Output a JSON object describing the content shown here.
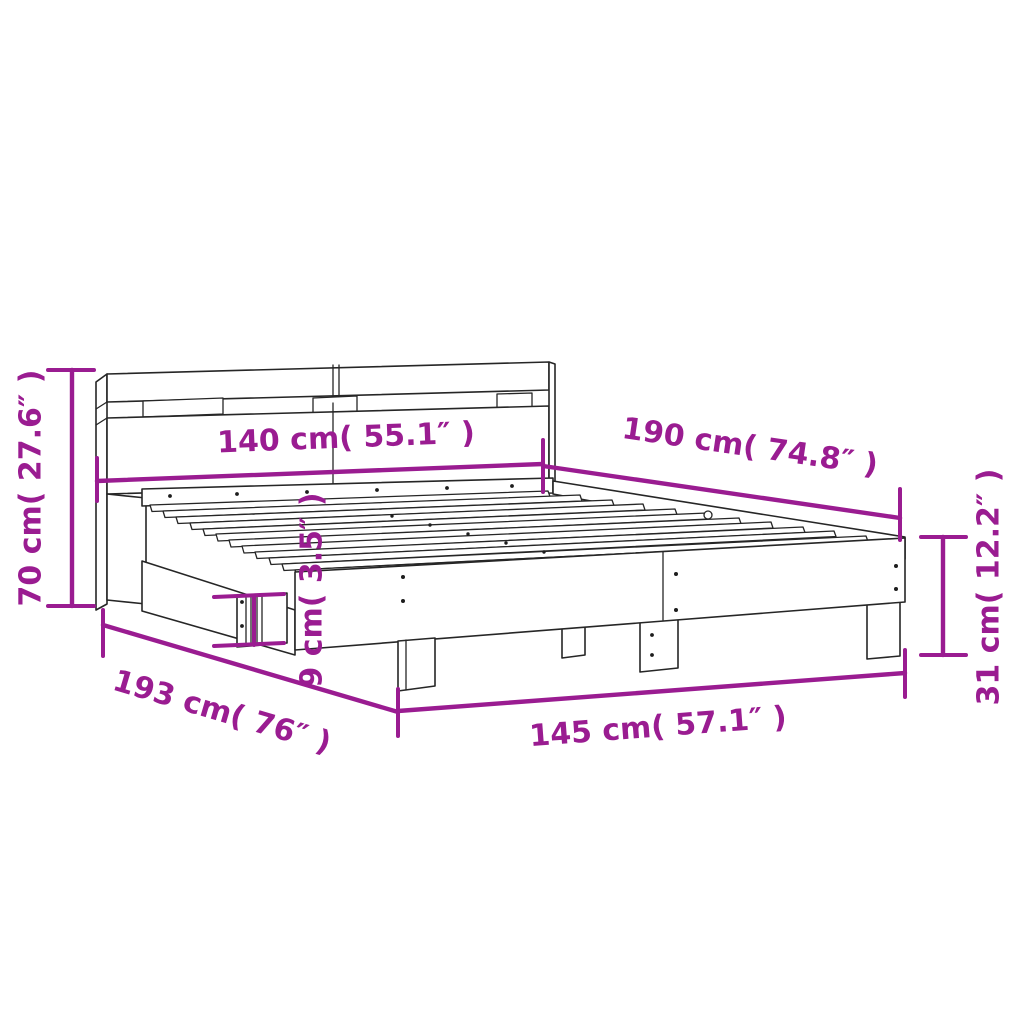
{
  "diagram": {
    "type": "product-dimension-diagram",
    "subject": "bed-frame-with-headboard",
    "background_color": "#ffffff",
    "line_color": "#262626",
    "accent_color": "#9A1C91",
    "units": {
      "metric": "cm",
      "imperial": "inch"
    },
    "dimensions": {
      "headboard_height": {
        "cm": 70,
        "inches": 27.6,
        "label": "70 cm( 27.6″ )",
        "orientation": "vertical-left"
      },
      "headboard_width": {
        "cm": 140,
        "inches": 55.1,
        "label": "140 cm( 55.1″ )",
        "orientation": "horizontal-top"
      },
      "bed_length": {
        "cm": 190,
        "inches": 74.8,
        "label": "190 cm( 74.8″ )",
        "orientation": "diagonal-upper-right"
      },
      "frame_height": {
        "cm": 31,
        "inches": 12.2,
        "label": "31 cm( 12.2″ )",
        "orientation": "vertical-right"
      },
      "rail_height": {
        "cm": 9,
        "inches": 3.5,
        "label": "9 cm( 3.5″ )",
        "orientation": "vertical-center"
      },
      "frame_length": {
        "cm": 193,
        "inches": 76,
        "label": "193 cm( 76″ )",
        "orientation": "diagonal-lower-left"
      },
      "frame_width": {
        "cm": 145,
        "inches": 57.1,
        "label": "145 cm( 57.1″ )",
        "orientation": "diagonal-lower-center"
      }
    }
  }
}
